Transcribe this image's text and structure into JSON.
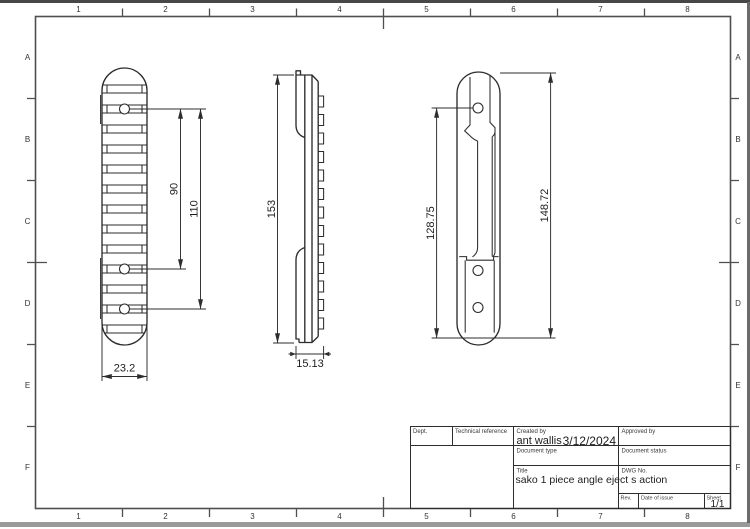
{
  "sheet": {
    "grid_cols": [
      "1",
      "2",
      "3",
      "4",
      "5",
      "6",
      "7",
      "8"
    ],
    "grid_rows": [
      "A",
      "B",
      "C",
      "D",
      "E",
      "F"
    ]
  },
  "dimensions": {
    "top_view": {
      "hole_span_inner": "90",
      "hole_span_outer": "110",
      "width": "23.2"
    },
    "side_view": {
      "height": "153",
      "base_width": "15.13"
    },
    "bottom_view": {
      "hole_to_base": "128.75",
      "overall_length": "148.72"
    }
  },
  "title_block": {
    "dept_label": "Dept.",
    "technical_reference_label": "Technical reference",
    "created_by_label": "Created by",
    "created_by_value": "ant wallis",
    "created_date": "3/12/2024",
    "approved_by_label": "Approved by",
    "document_type_label": "Document type",
    "document_status_label": "Document status",
    "title_label": "Title",
    "title_value": "sako 1 piece angle eject s action",
    "dwg_no_label": "DWG No.",
    "rev_label": "Rev.",
    "date_of_issue_label": "Date of issue",
    "sheet_label": "Sheet",
    "sheet_value": "1/1"
  },
  "colors": {
    "line": "#2d2d2d",
    "frame": "#4f4f4f",
    "background": "#ffffff"
  }
}
